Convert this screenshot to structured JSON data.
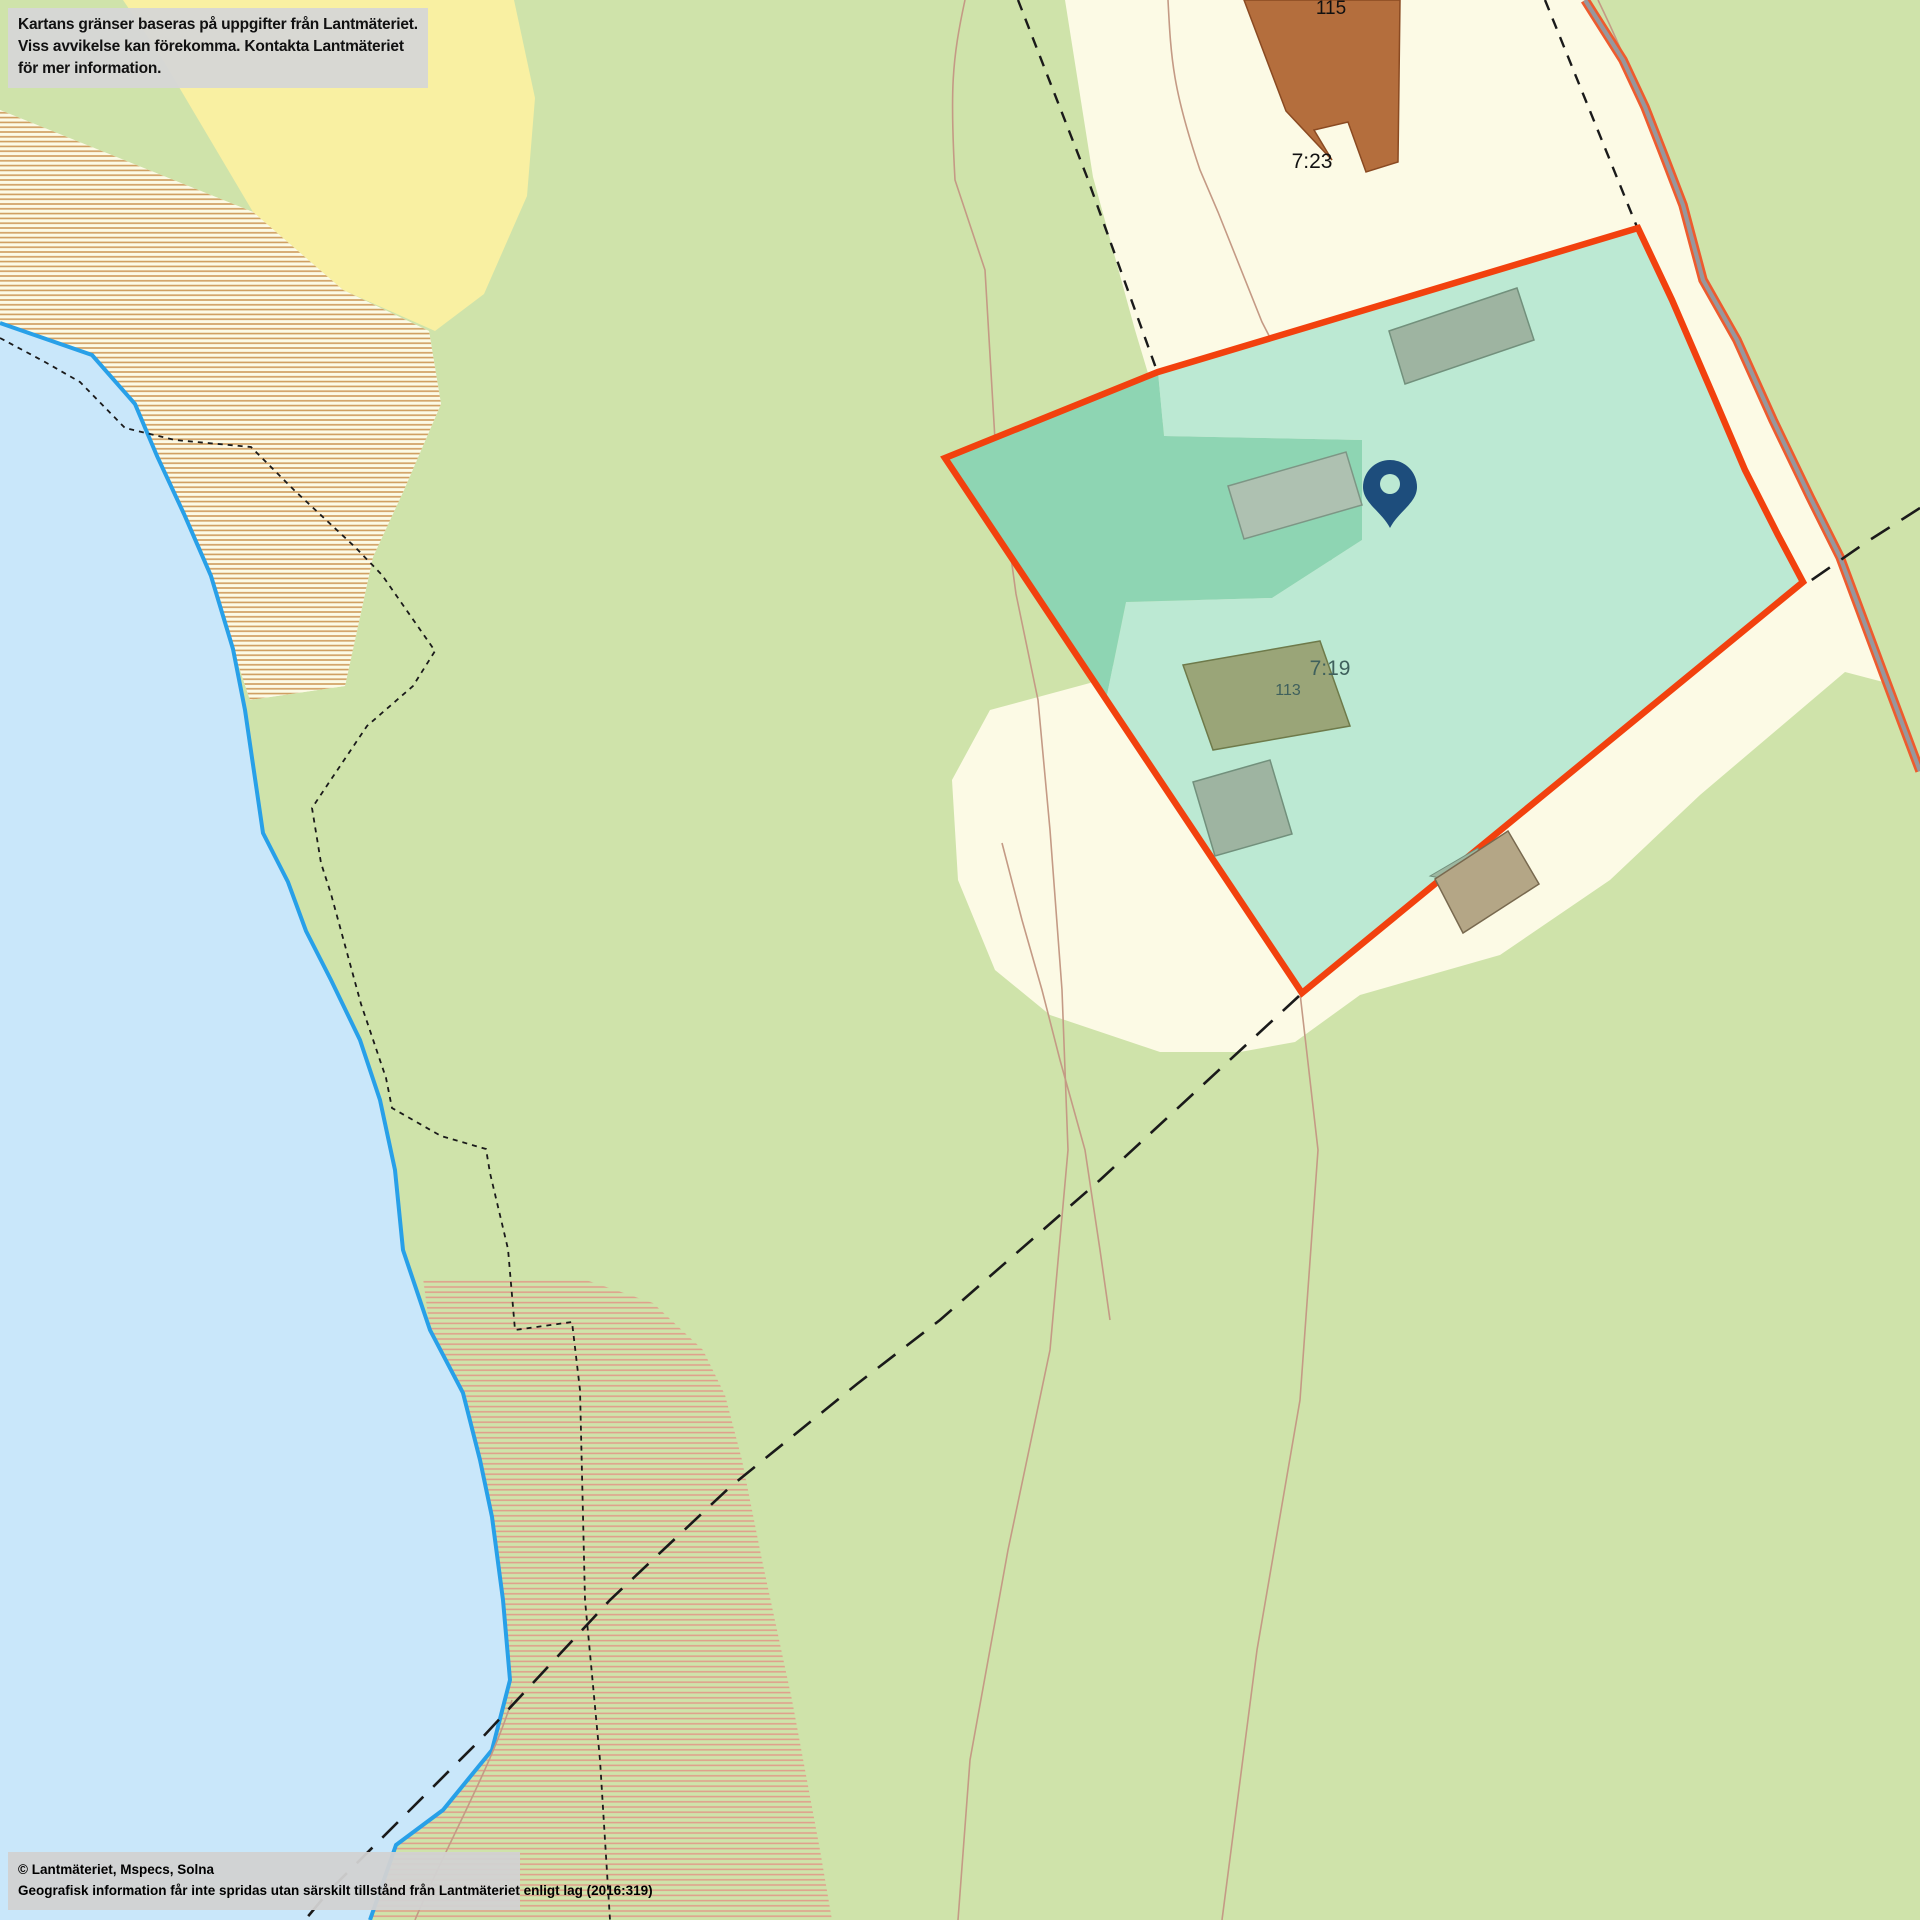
{
  "notice": {
    "line1": "Kartans gränser baseras på uppgifter från Lantmäteriet.",
    "line2": "Viss avvikelse kan förekomma. Kontakta Lantmäteriet för mer information."
  },
  "attribution": {
    "line1": "© Lantmäteriet, Mspecs, Solna",
    "line2": "Geografisk information får inte spridas utan särskilt tillstånd från Lantmäteriet enligt lag (2016:319)"
  },
  "map": {
    "labels": {
      "neighbor_building": "115",
      "neighbor_property": "7:23",
      "selected_property": "7:19",
      "selected_building": "113"
    },
    "marker": {
      "icon": "location-pin-icon",
      "color": "#1d4d7c"
    },
    "colors": {
      "forest_green": "#cfe3aa",
      "open_land_cream": "#fcfae5",
      "field_yellow": "#f9f0a2",
      "water_blue": "#c9e7fa",
      "shoreline_blue": "#28a0e8",
      "wetland_hatch_tan": "#cf9d5d",
      "wetland_hatch_salmon": "#dfa18c",
      "parcel_fill_dark": "#8ed5b3",
      "parcel_fill_light": "#bce9d3",
      "parcel_border_red": "#f2410e",
      "road_gray": "#97979d",
      "road_edge_orange": "#ee5b2e",
      "building_brown": "#b46e3d",
      "building_gray_green": "#9eb4a1",
      "building_khaki": "#9aa578",
      "building_beige": "#b4a686",
      "label_teal": "#3f605c",
      "boundary_dash_black": "#1a1a1a",
      "path_brown": "#c49a85"
    }
  }
}
